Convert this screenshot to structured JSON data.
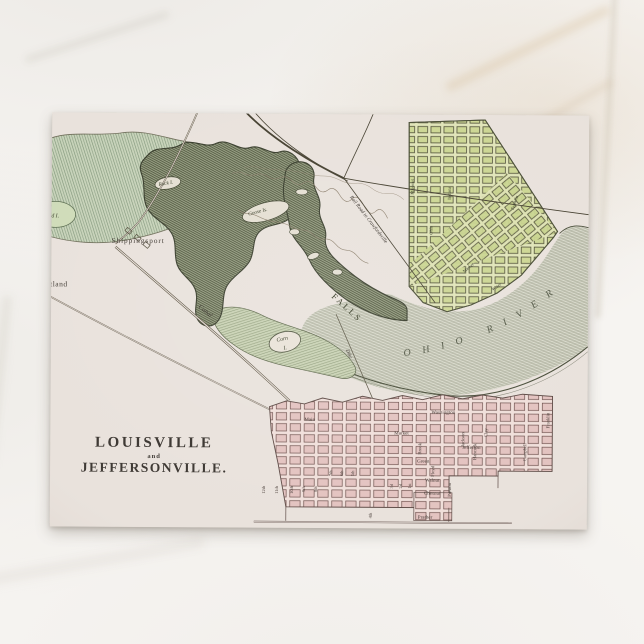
{
  "postcard": {
    "title": {
      "line1": "LOUISVILLE",
      "line2": "and",
      "line3": "JEFFERSONVILLE."
    },
    "map": {
      "labels": {
        "river": "OHIO RIVER",
        "falls": "FALLS",
        "canal": "Canal",
        "dike": "Dike",
        "railroad": "Rail Road to Crawfordsville",
        "shippingsport": "Shippingsport",
        "portland": "Portland",
        "sand_island": "Sand I.",
        "rock_island": "Rock I.",
        "goose_island": "Goose Is.",
        "corn_island_1": "Corn",
        "corn_island_2": "I."
      },
      "louisville": {
        "streets_h": [
          "Washington",
          "Main",
          "Market",
          "Jefferson",
          "Green",
          "Walnut",
          "Chesnut",
          "Prather"
        ],
        "streets_v": [
          "Brook",
          "Floyd",
          "Preston",
          "Jackson",
          "Hancock",
          "Clay",
          "Campbell",
          "Franklin"
        ],
        "streets_n": [
          "12th",
          "11th",
          "10th",
          "9th",
          "8th",
          "7th",
          "6th",
          "5th",
          "4th",
          "3d",
          "2d",
          "1st"
        ]
      },
      "jeffersonville": {
        "streets": [
          "Missouri",
          "Indiana",
          "Ohio",
          "Franklin",
          "Market",
          "Water"
        ]
      }
    },
    "colors": {
      "marble": "#f6f4f1",
      "card_paper": "#e9e2dc",
      "jeffersonville_green": "#ccd693",
      "louisville_pink": "#e3c3c0",
      "water_green": "#c8d3ba",
      "river_ink": "#4b5038",
      "ink": "#3f3a35"
    }
  }
}
